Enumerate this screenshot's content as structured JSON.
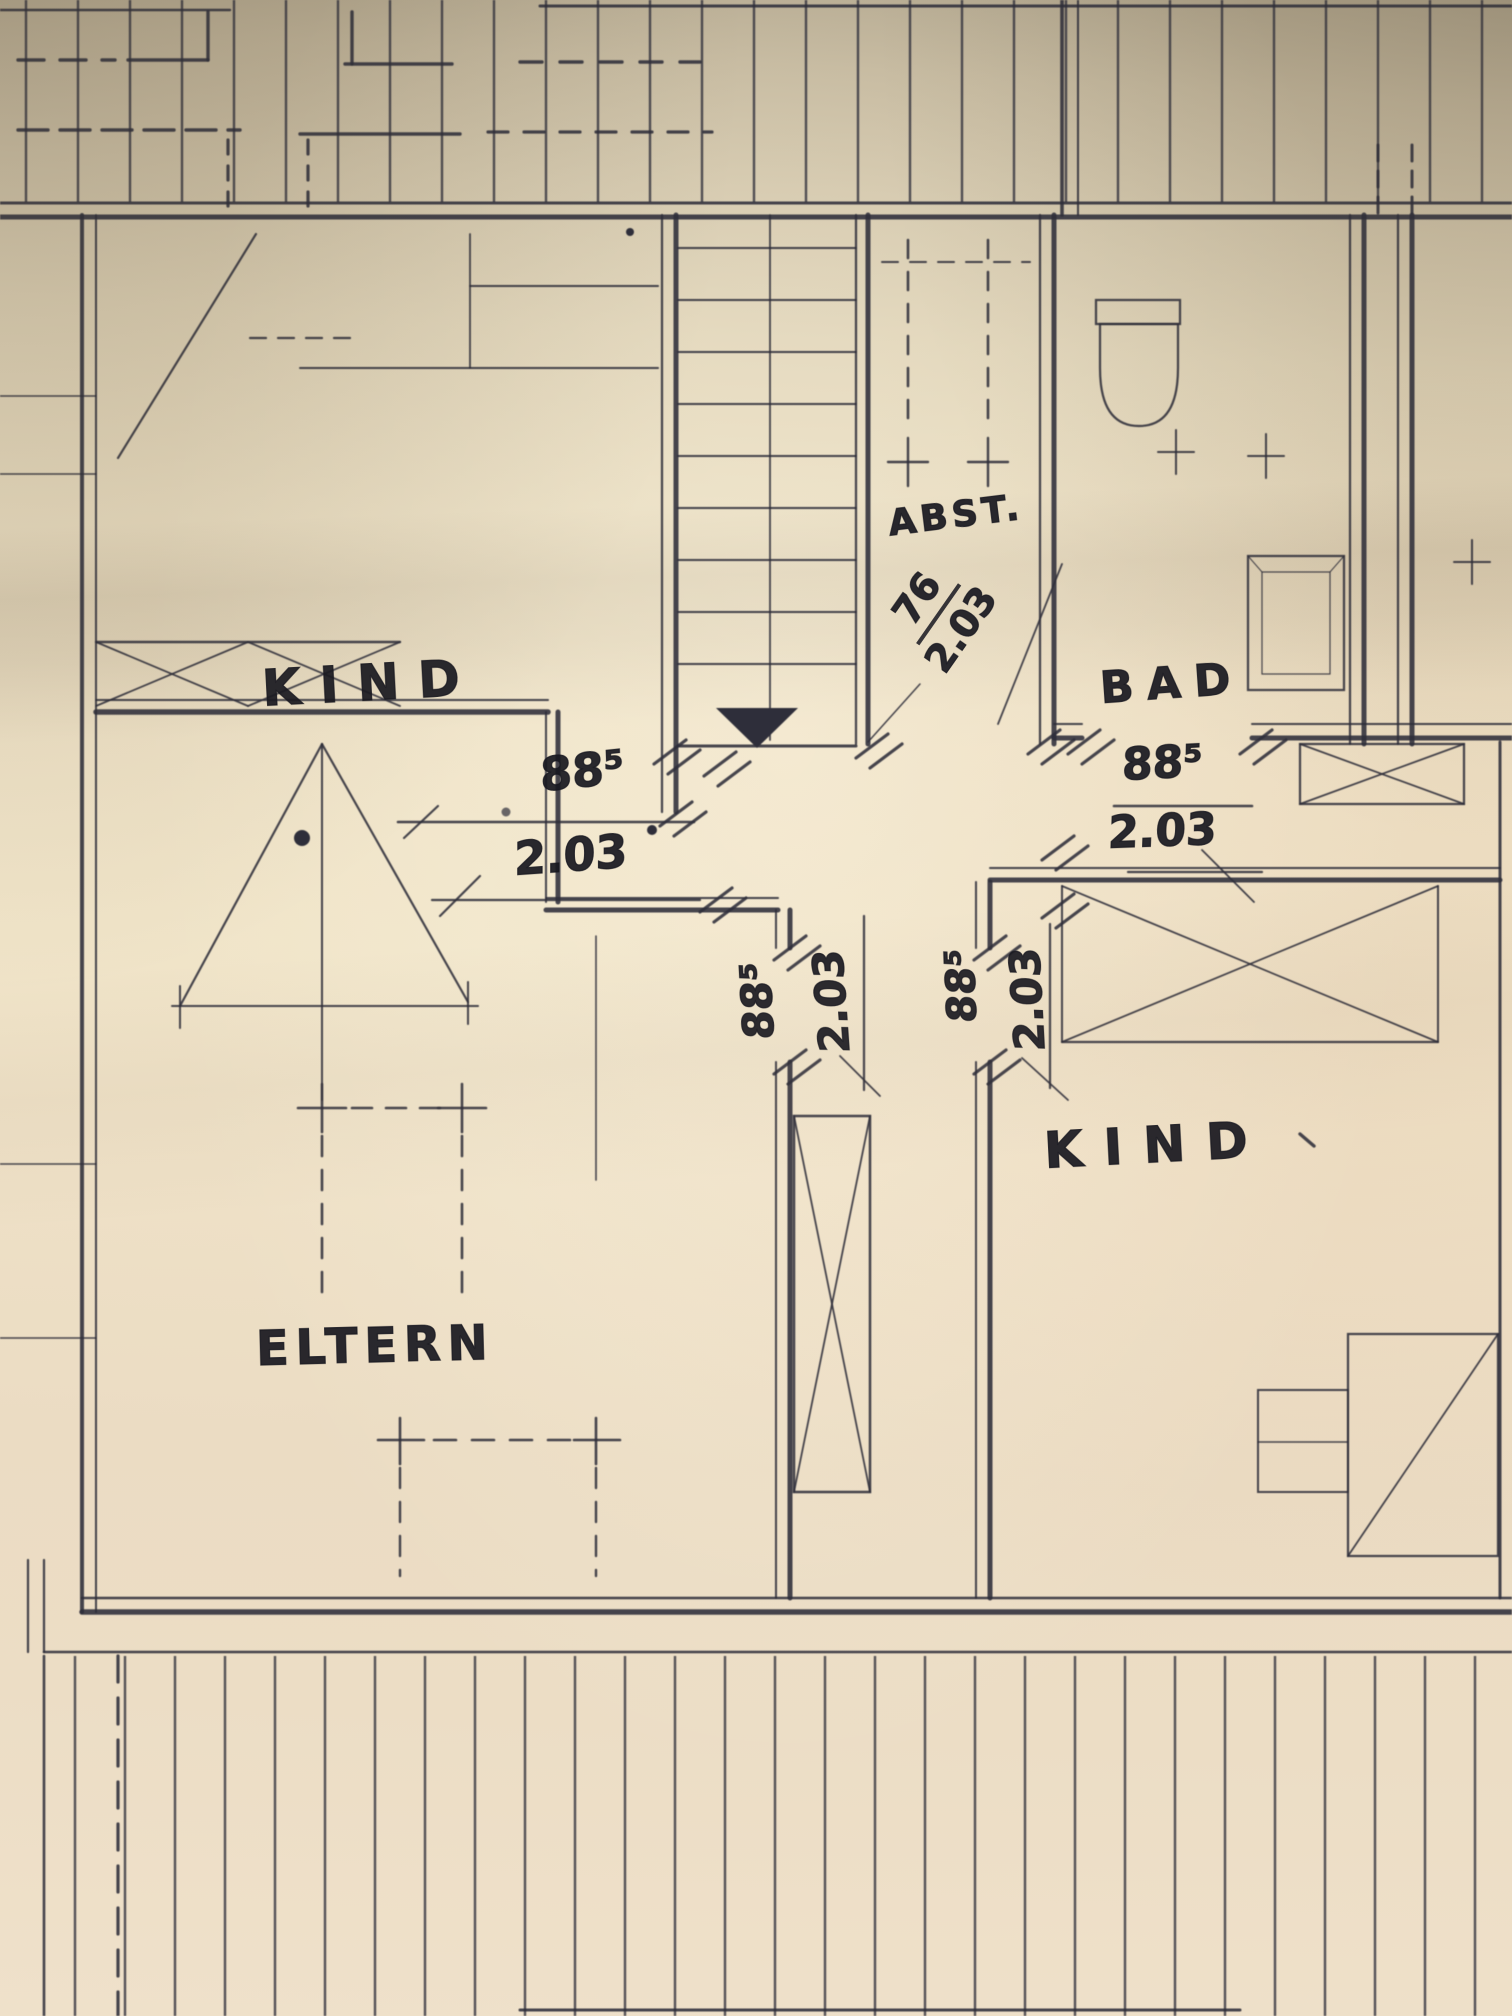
{
  "plan": {
    "rooms": {
      "kind_top": {
        "label": "KIND"
      },
      "abst": {
        "label": "ABST."
      },
      "bad": {
        "label": "BAD"
      },
      "eltern": {
        "label": "ELTERN"
      },
      "kind_bottom": {
        "label": "KIND"
      }
    },
    "dimensions": {
      "door_kind_top": {
        "width": "88⁵",
        "height": "2.03"
      },
      "door_abst": {
        "width": "76",
        "height": "2.03"
      },
      "door_bad": {
        "width": "88⁵",
        "height": "2.03"
      },
      "door_eltern": {
        "width": "88⁵",
        "height": "2.03"
      },
      "door_kind_bottom": {
        "width": "88⁵",
        "height": "2.03"
      }
    },
    "colors": {
      "ink": "#2e2e3a",
      "hand_ink": "#18181f",
      "paper_light": "#f0e4c8",
      "paper_dark": "#ab9f86"
    }
  }
}
